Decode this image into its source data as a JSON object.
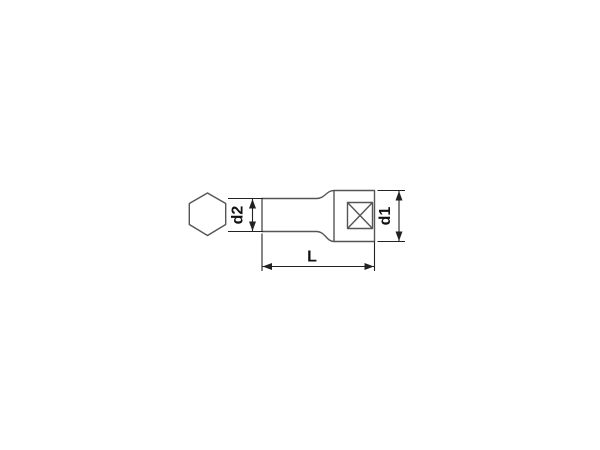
{
  "title": "Socket technical drawing",
  "theme": {
    "bg": "#ffffff",
    "outline": "#555555",
    "dim": "#222222",
    "text": "#111111"
  },
  "diagram": {
    "labels": {
      "d2": "d2",
      "d1": "d1",
      "length": "L"
    }
  }
}
